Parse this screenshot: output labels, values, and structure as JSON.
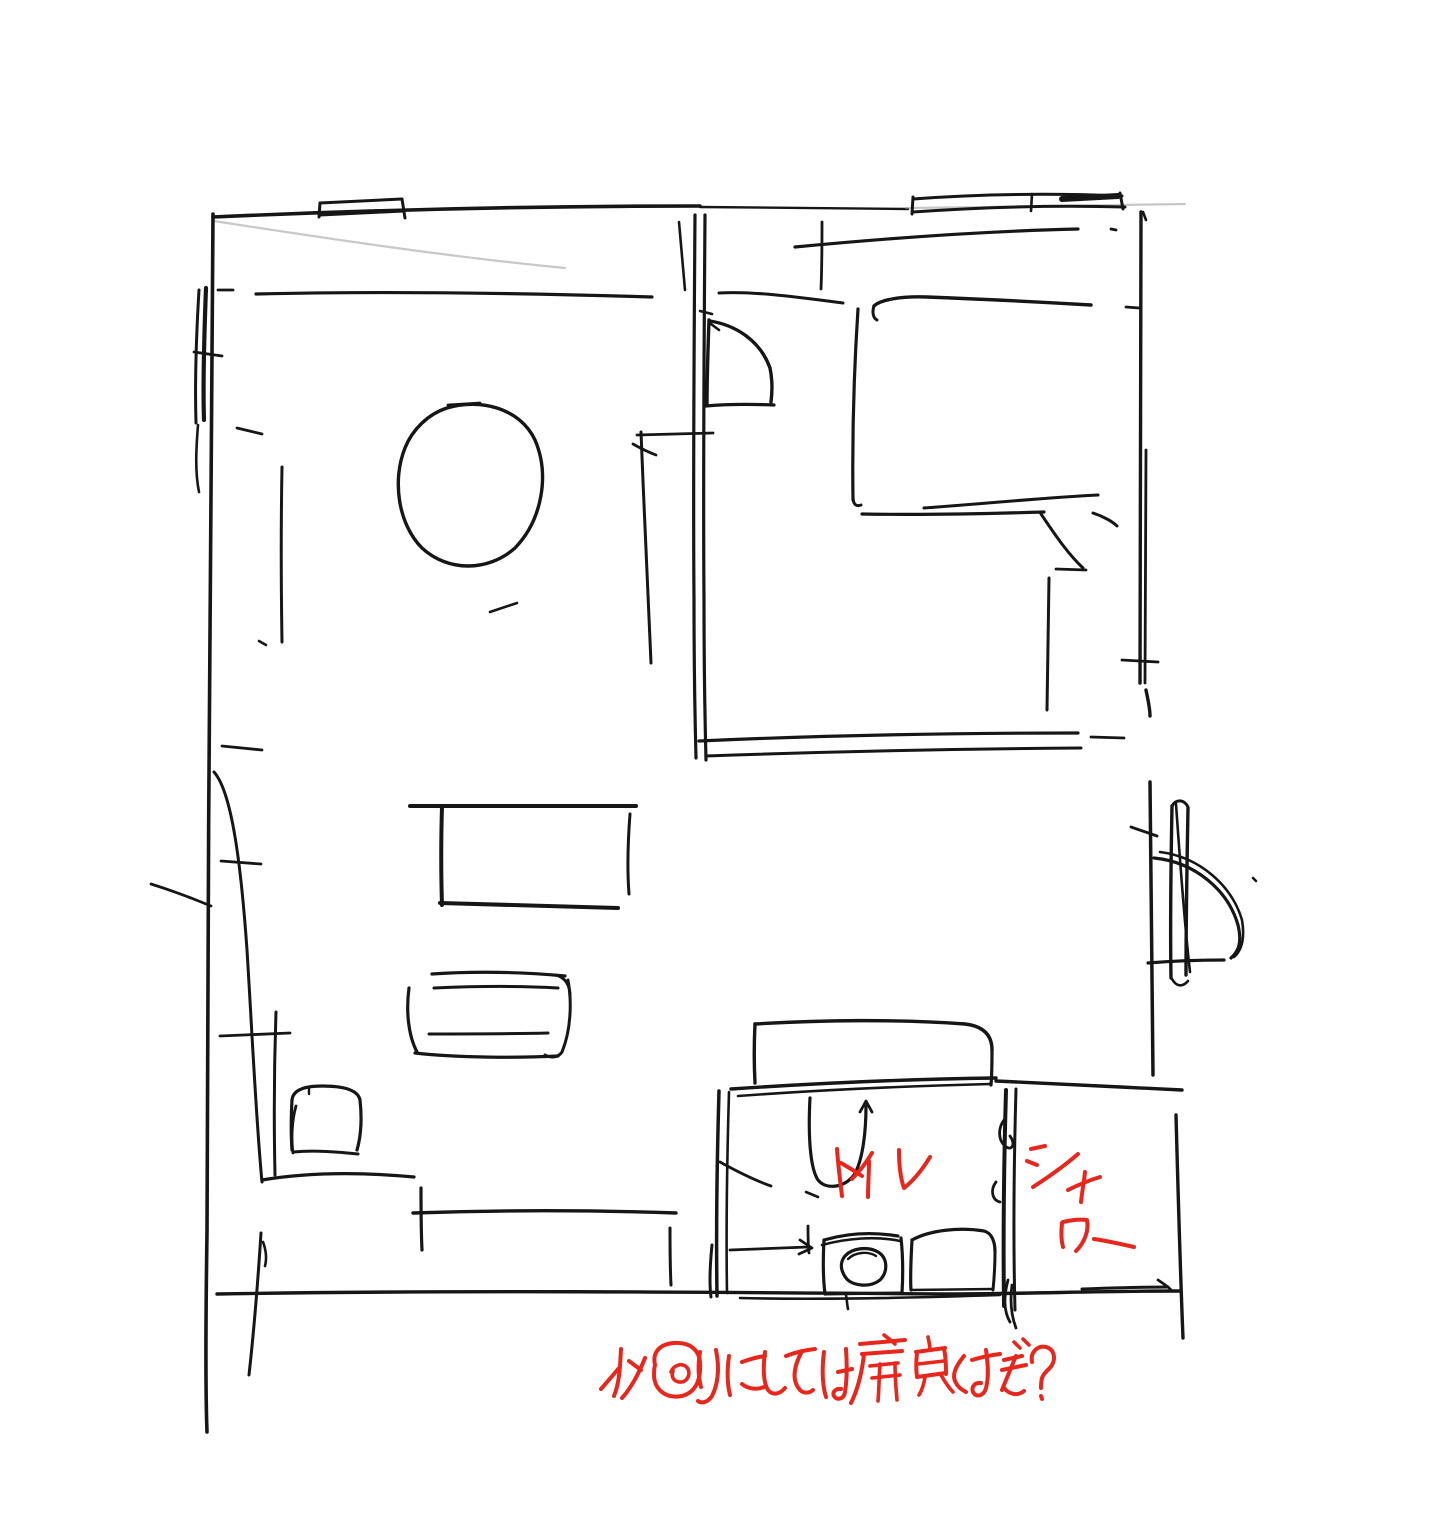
{
  "canvas": {
    "width": 1453,
    "height": 1522,
    "background": "#ffffff"
  },
  "sketch": {
    "type": "hand-drawn floor plan",
    "ink_color": "#161616",
    "faint_line_color": "#9a9a9a",
    "annotation_color": "#e8261c",
    "labels": {
      "toilet": "トイレ",
      "shower_line1": "シャ",
      "shower_line2": "ワー",
      "note": "水回りにしては扉良すぎ?"
    }
  }
}
